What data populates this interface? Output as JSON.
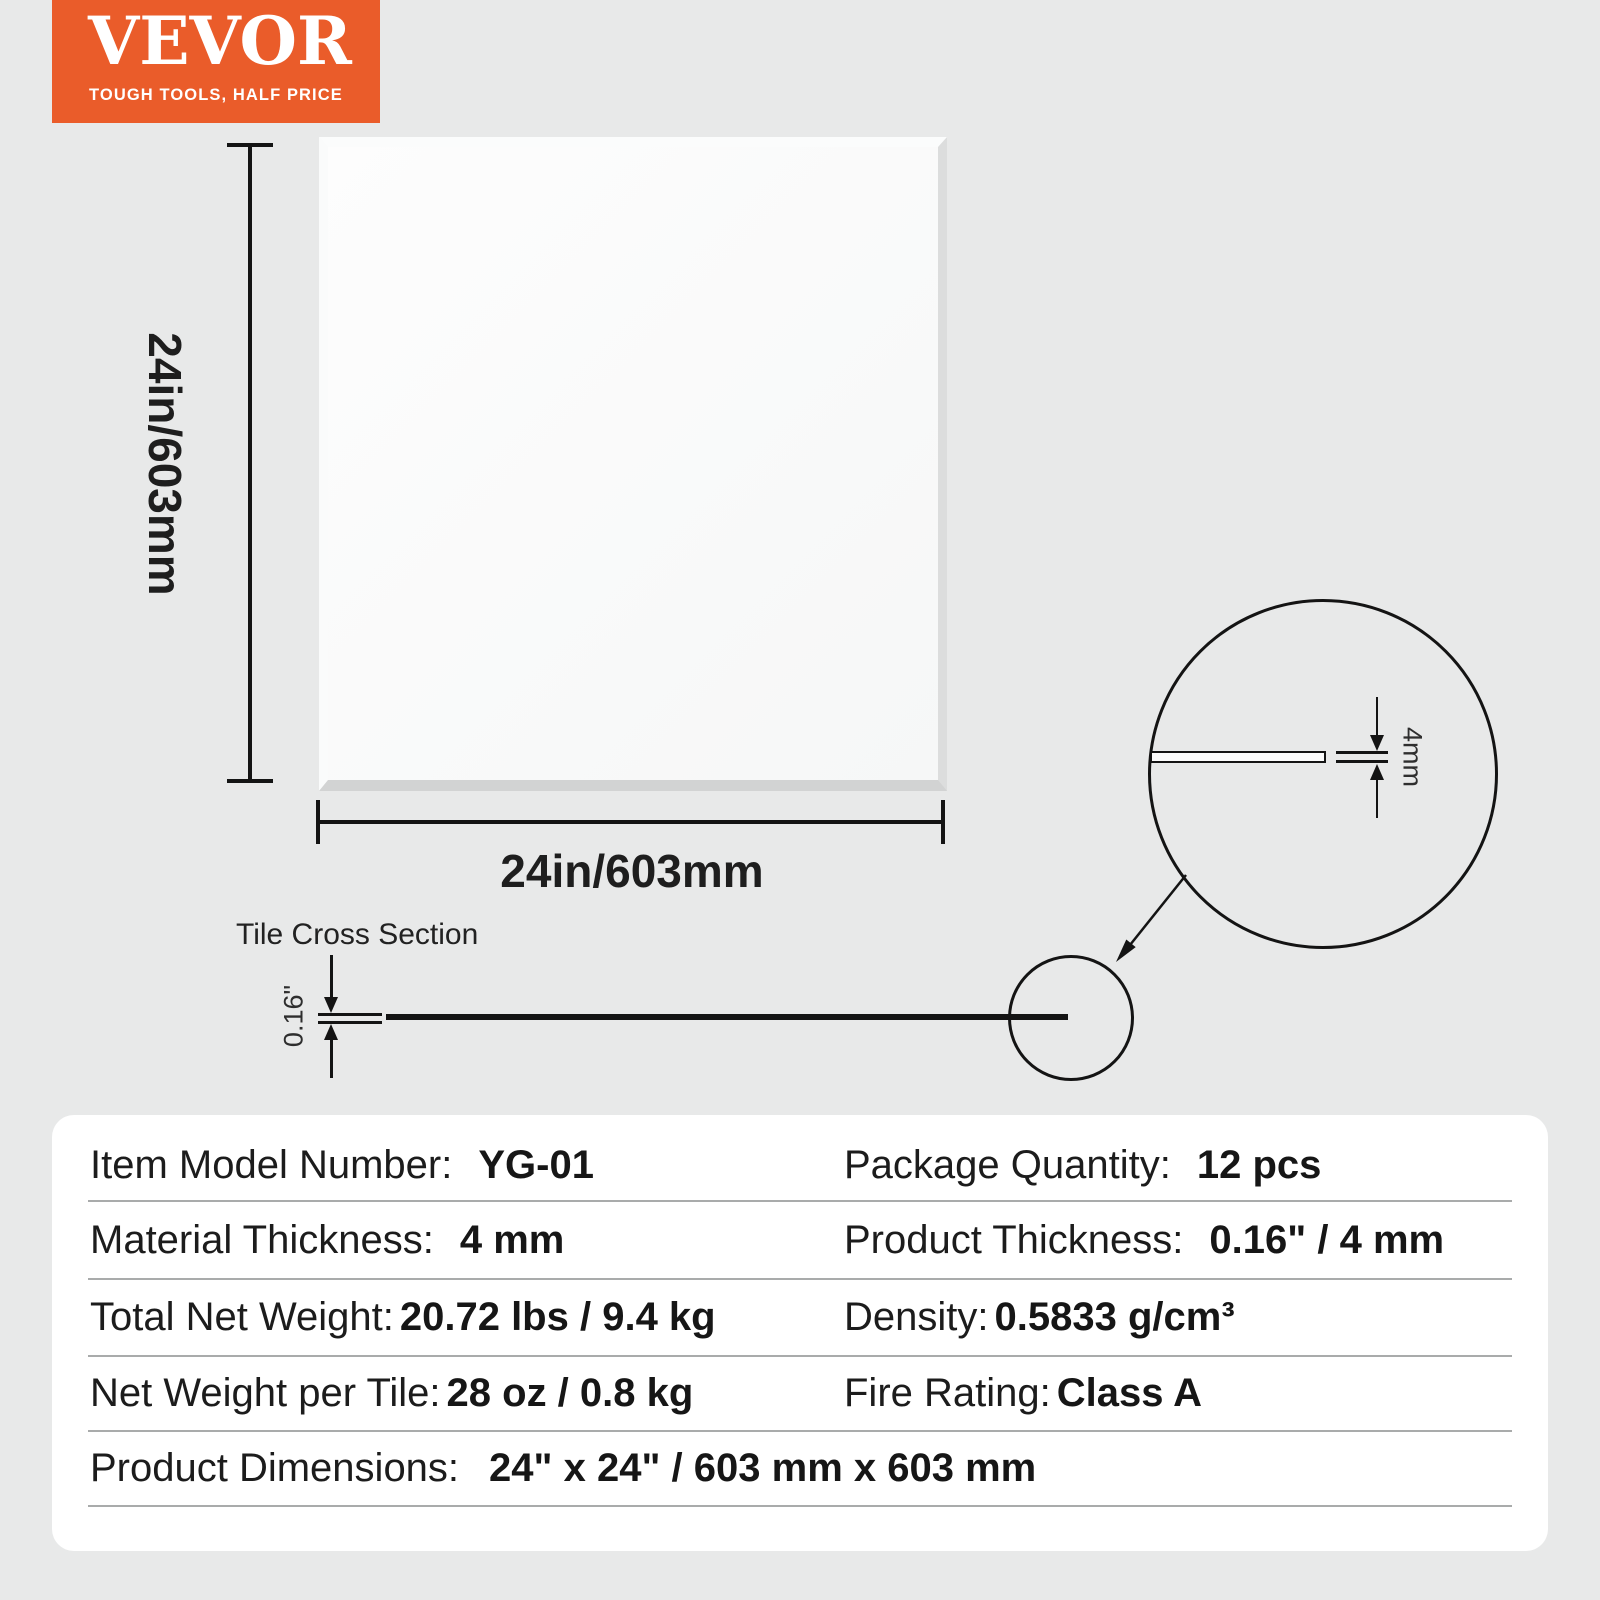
{
  "logo": {
    "brand": "VEVOR",
    "tagline": "TOUGH TOOLS, HALF PRICE",
    "bg_color": "#ea5c2a",
    "text_color": "#ffffff"
  },
  "diagram": {
    "tile_height_label": "24in/603mm",
    "tile_width_label": "24in/603mm",
    "cross_section": {
      "title": "Tile Cross Section",
      "thickness_label": "0.16\""
    },
    "detail": {
      "thickness_label": "4mm"
    }
  },
  "specs": {
    "rows": [
      {
        "cells": [
          {
            "label": "Item Model Number:",
            "value": "YG-01"
          },
          {
            "label": "Package Quantity:",
            "value": "12 pcs"
          }
        ]
      },
      {
        "cells": [
          {
            "label": "Material Thickness:",
            "value": "4 mm"
          },
          {
            "label": "Product Thickness:",
            "value": "0.16\" / 4 mm"
          }
        ]
      },
      {
        "cells": [
          {
            "label": "Total Net Weight:",
            "value": "20.72 lbs / 9.4 kg"
          },
          {
            "label": "Density:",
            "value": "0.5833 g/cm³"
          }
        ]
      },
      {
        "cells": [
          {
            "label": "Net Weight per Tile:",
            "value": "28 oz / 0.8 kg"
          },
          {
            "label": "Fire Rating:",
            "value": "Class A"
          }
        ]
      },
      {
        "cells": [
          {
            "label": "Product Dimensions:",
            "value": "24\" x 24\" / 603 mm x 603 mm"
          }
        ]
      }
    ]
  }
}
